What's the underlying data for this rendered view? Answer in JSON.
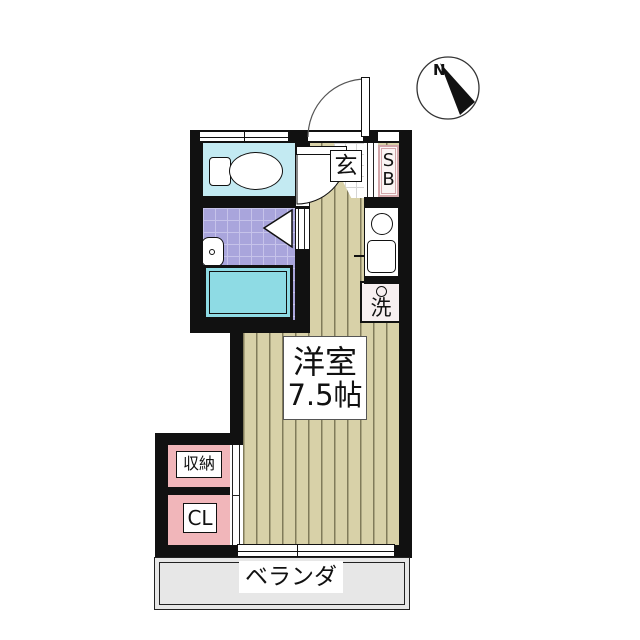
{
  "compass": {
    "north_label": "N"
  },
  "rooms": {
    "main_room": {
      "name": "洋室",
      "size": "7.5帖"
    },
    "entrance": {
      "label": "玄"
    },
    "shoe_box": {
      "line1": "S",
      "line2": "B"
    },
    "washer": {
      "label": "洗"
    },
    "storage": {
      "label": "収納"
    },
    "closet": {
      "label": "CL"
    },
    "veranda": {
      "label": "ベランダ"
    }
  },
  "colors": {
    "wall": "#111111",
    "wood": "#d8d1a8",
    "toilet_floor": "#c3eaf2",
    "bath_tile": "#a9a5dc",
    "bath_tile_line": "#c6c3ea",
    "bathtub": "#8edbe4",
    "closet_pink": "#f1b6ba",
    "shoebox_border": "#d3a6aa",
    "washer_bg": "#f7eff0",
    "veranda_bg": "#e7e7e7",
    "tile_line": "#d5d5d5"
  }
}
